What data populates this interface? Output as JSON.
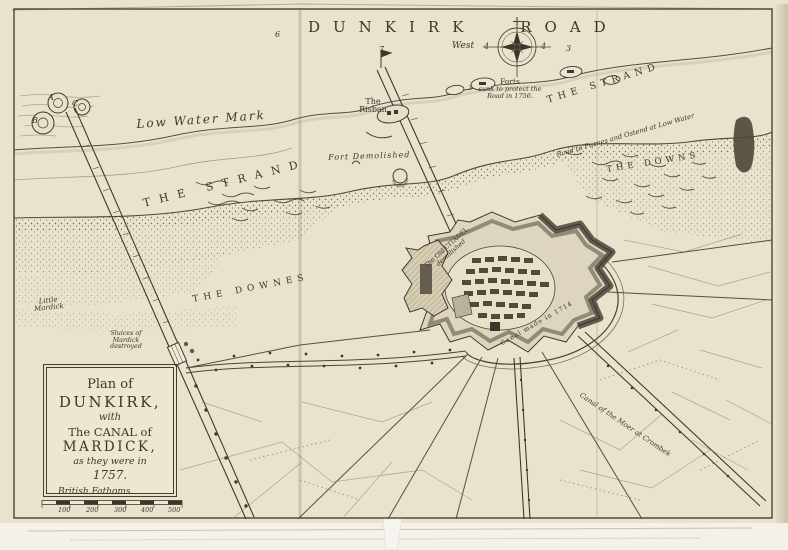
{
  "plate": {
    "sea_title": "DUNKIRK ROAD",
    "compass_west": "West"
  },
  "labels": {
    "low_water_mark": "Low Water Mark",
    "strand_left": "THE STRAND",
    "strand_right": "THE STRAND",
    "downes_left": "THE DOWNES",
    "downs_right": "THE DOWNS",
    "risban": {
      "l1": "The",
      "l2": "Risban"
    },
    "fort_demolished": "Fort Demolished",
    "forts_note": {
      "l1": "Forts",
      "l2": "sunk to protect the",
      "l3": "Road in 1756."
    },
    "road_furnes": "Road to Furnes and Ostend at Low Water",
    "old_citadel": {
      "l1": "The Old CITADEL",
      "l2": "demolished"
    },
    "canal_1714": "Canal made in 1714",
    "canal_moer": "Canal of the Moer at Crombek",
    "sluices": {
      "l1": "Sluices of",
      "l2": "Mardick",
      "l3": "destroyed"
    },
    "little_mardick": {
      "l1": "Little",
      "l2": "Mardick"
    }
  },
  "jetty_letters": {
    "a": "A",
    "b": "B",
    "c": "C"
  },
  "soundings": [
    {
      "value": "6"
    },
    {
      "value": "7"
    },
    {
      "value": "3"
    },
    {
      "value": "4"
    },
    {
      "value": "4"
    },
    {
      "value": "3"
    }
  ],
  "cartouche": {
    "line1": "Plan of",
    "line2": "DUNKIRK,",
    "line3": "with",
    "line4": "The CANAL of",
    "line5": "MARDICK,",
    "line6": "as they were in",
    "line7": "1757."
  },
  "scale_bar": {
    "label": "British Fathoms.",
    "ticks": [
      "100",
      "200",
      "300",
      "400",
      "500"
    ]
  },
  "colors": {
    "paper": "#e9e2cd",
    "ink": "#3c372c"
  }
}
